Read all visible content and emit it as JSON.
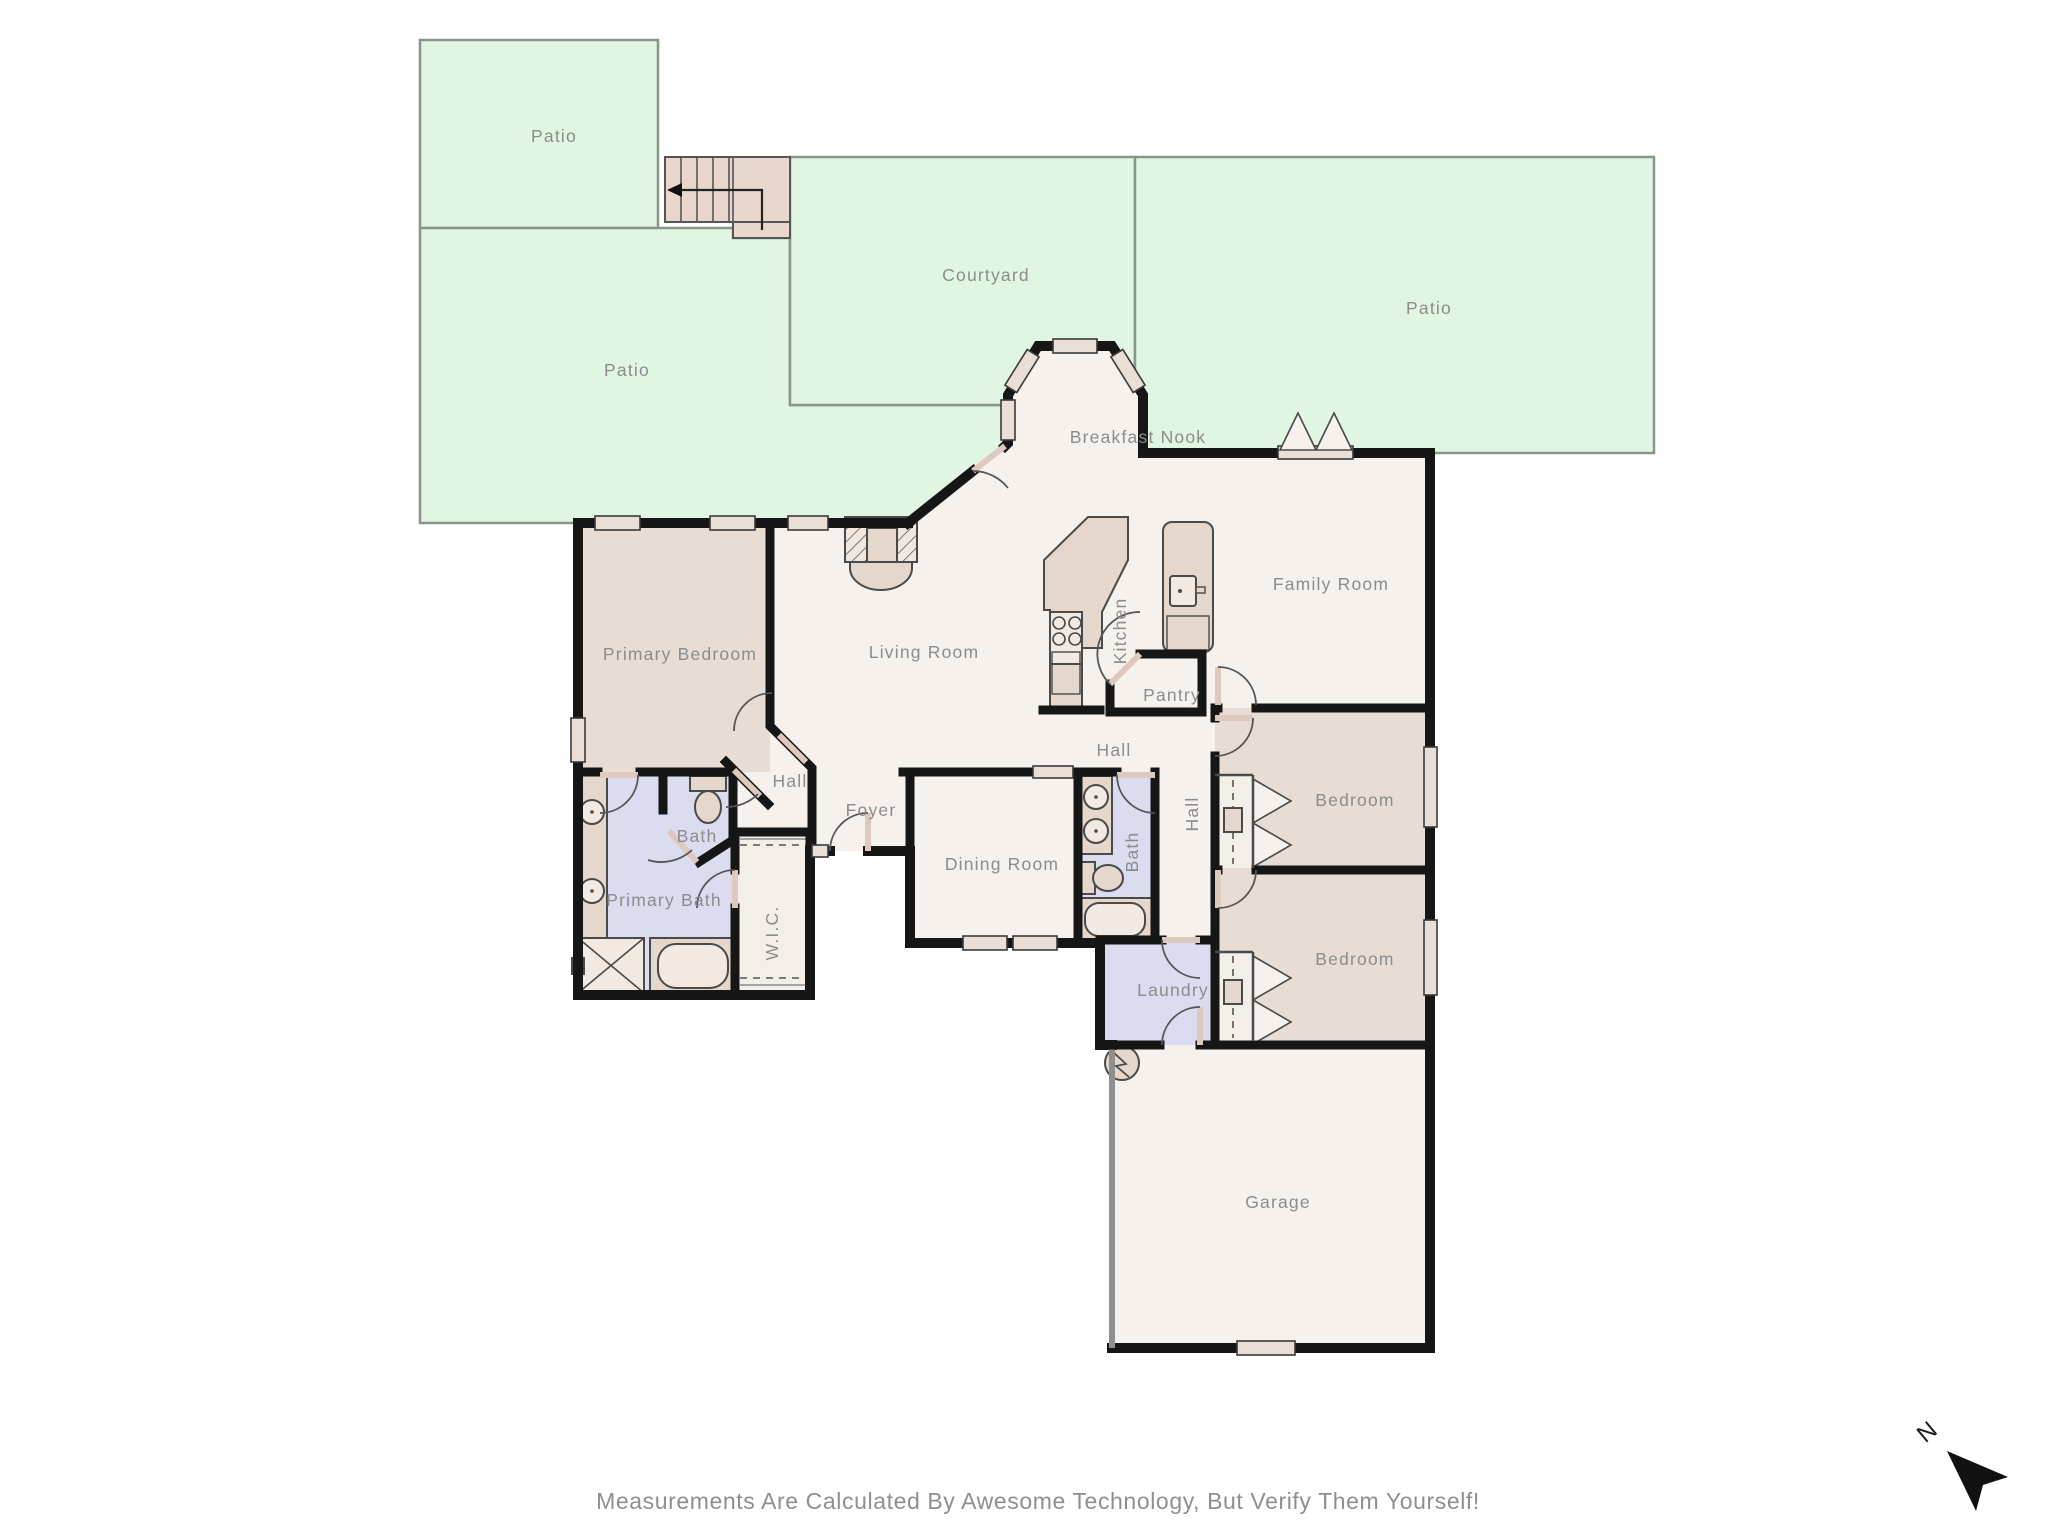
{
  "disclaimer": "Measurements Are Calculated By Awesome Technology, But Verify Them Yourself!",
  "compass": {
    "north_label": "N"
  },
  "rooms": {
    "patio_top_left": "Patio",
    "patio_left": "Patio",
    "courtyard": "Courtyard",
    "patio_right": "Patio",
    "breakfast_nook": "Breakfast Nook",
    "family_room": "Family Room",
    "primary_bedroom": "Primary Bedroom",
    "living_room": "Living Room",
    "kitchen": "Kitchen",
    "pantry": "Pantry",
    "hall_kitchen": "Hall",
    "hall_primary": "Hall",
    "hall_bedrooms": "Hall",
    "foyer": "Foyer",
    "dining_room": "Dining Room",
    "bath_hall": "Bath",
    "bath_primary_wc": "Bath",
    "primary_bath": "Primary Bath",
    "wic": "W.I.C.",
    "bedroom_1": "Bedroom",
    "bedroom_2": "Bedroom",
    "laundry": "Laundry",
    "garage": "Garage"
  },
  "colors": {
    "outdoor_green": "#e1f6e2",
    "floor": "#f6f1ec",
    "bedroom_floor": "#e7ddd5",
    "bath_floor": "#dcdcf0",
    "stairs_fill": "#e9d7ce",
    "fixture_fill": "#e6d7cc",
    "wall": "#161616",
    "label_text": "#8c8c8c"
  }
}
